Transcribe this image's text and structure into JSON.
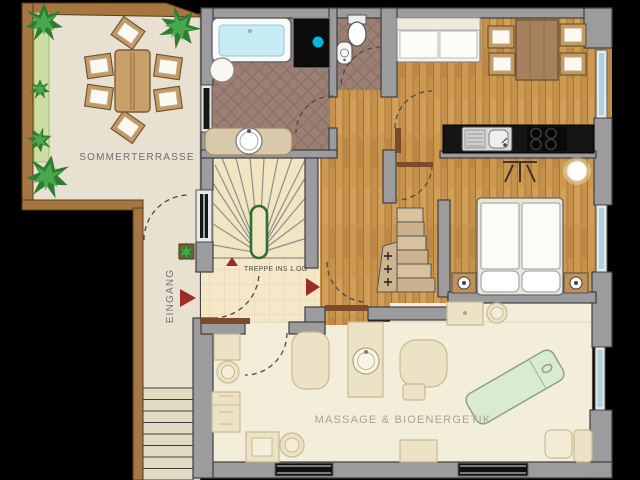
{
  "labels": {
    "terrace": "SOMMERTERRASSE",
    "entrance": "EINGANG",
    "staircase": "TREPPE INS 1.OG",
    "massage_room": "MASSAGE & BIOENERGETIK"
  },
  "colors": {
    "background": "#000000",
    "wall_gray": "#9c9c9e",
    "terrace_floor": "#e8e1d1",
    "deck_brown": "#a5763f",
    "planting_strip_green": "#ccdca2",
    "plant_green": "#2e7d32",
    "wood_floor": "#c5914c",
    "cream_tile_floor": "#f4e8c8",
    "bath_tile_floor": "#9b7f73",
    "massage_floor": "#f3eeda",
    "accent_red_arrow": "#9e2b25",
    "handrail_green": "#2f6d35",
    "bathtub_water": "#c7ecf5",
    "shower_dot_cyan": "#00b8dc",
    "massage_table_green": "#daeccf",
    "window_glass": "#a9d4de",
    "counter_black": "#151515"
  },
  "rooms": [
    {
      "name": "sommerterrasse",
      "fixtures": [
        "dining-table",
        "chair",
        "chair",
        "chair",
        "chair",
        "chair",
        "chair",
        "plant",
        "plant",
        "plant",
        "plant",
        "plant"
      ]
    },
    {
      "name": "bathroom",
      "fixtures": [
        "bathtub",
        "shower",
        "stool",
        "vanity-sink"
      ]
    },
    {
      "name": "wc",
      "fixtures": [
        "toilet",
        "hand-sink"
      ]
    },
    {
      "name": "living-kitchen",
      "fixtures": [
        "sofa",
        "dining-table",
        "chairs",
        "kitchen-sink",
        "cooktop",
        "counter"
      ]
    },
    {
      "name": "bedroom",
      "fixtures": [
        "double-bed",
        "nightstand",
        "nightstand",
        "lamp"
      ]
    },
    {
      "name": "staircase-hall",
      "fixtures": [
        "winder-stairs",
        "handrail"
      ]
    },
    {
      "name": "massage-room",
      "fixtures": [
        "massage-table",
        "desk",
        "stools",
        "cabinet",
        "wash-basin"
      ]
    }
  ]
}
